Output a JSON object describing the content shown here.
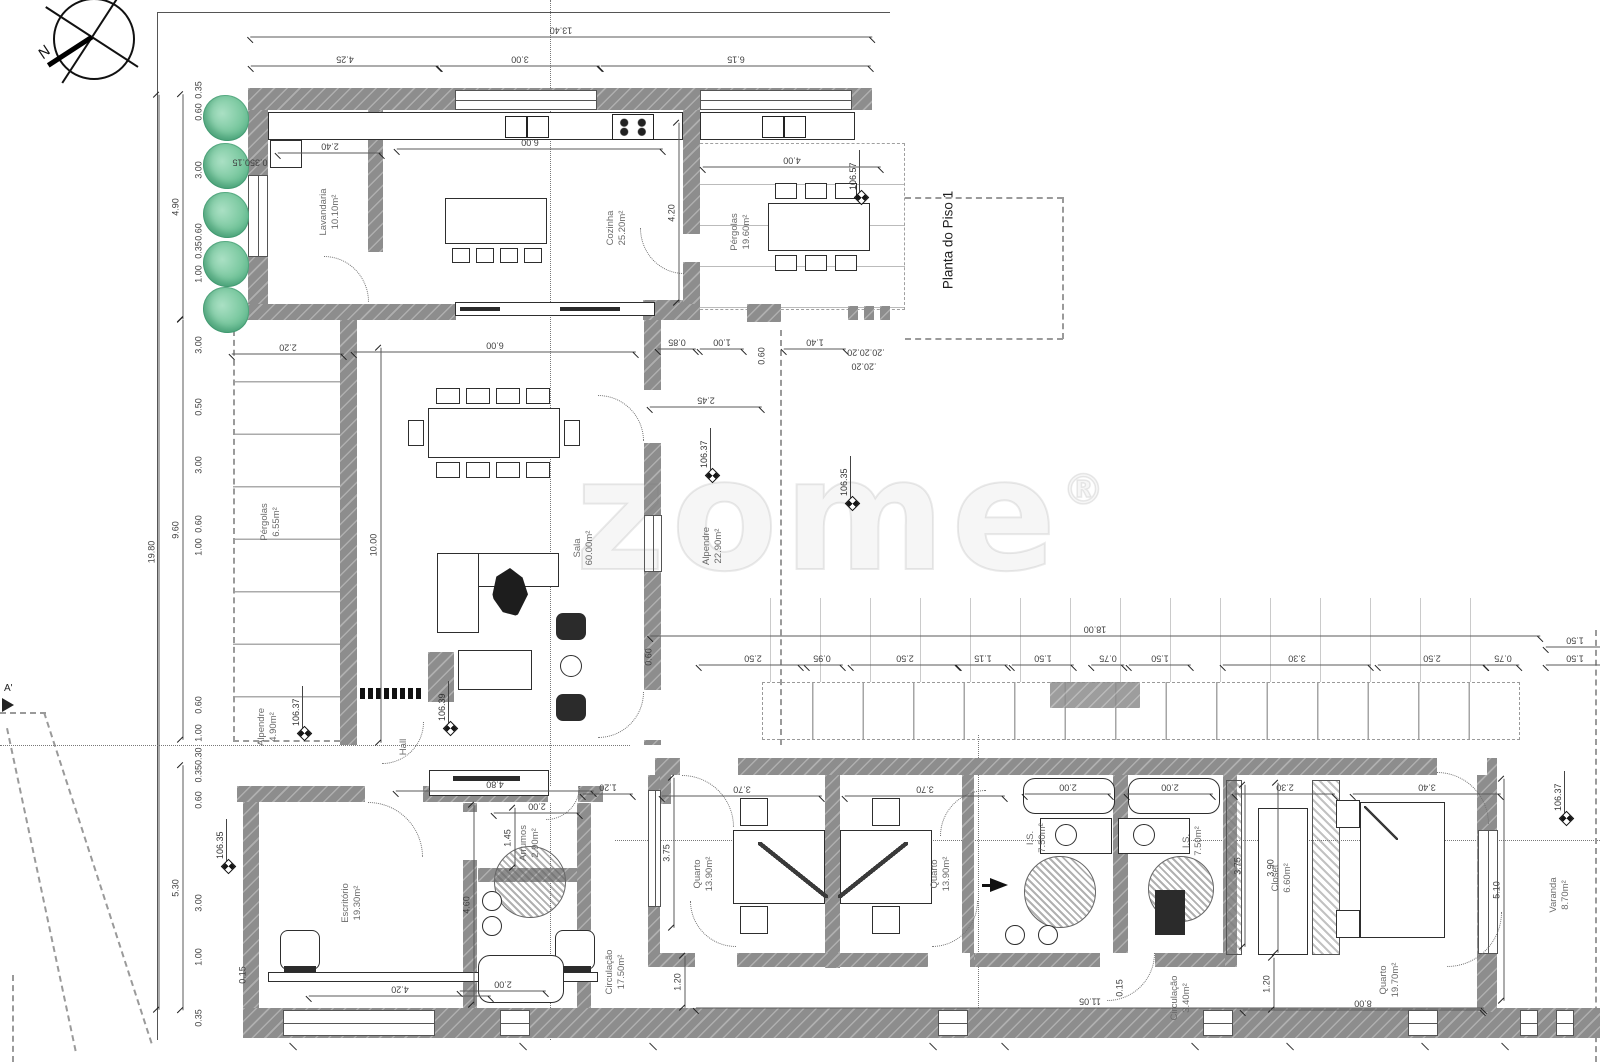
{
  "title": "Planta do Piso 1",
  "watermark": "zome",
  "watermark_reg": "®",
  "compass_label": "N",
  "section_label": "A'",
  "rooms": [
    {
      "n": "Lavandaria",
      "a": "10.10m²",
      "x": 330,
      "y": 212
    },
    {
      "n": "Cozinha",
      "a": "25.20m²",
      "x": 617,
      "y": 228
    },
    {
      "n": "Pérgolas",
      "a": "19.60m²",
      "x": 741,
      "y": 232
    },
    {
      "n": "Pérgolas",
      "a": "6.55m²",
      "x": 271,
      "y": 522
    },
    {
      "n": "Sala",
      "a": "60.00m²",
      "x": 584,
      "y": 548
    },
    {
      "n": "Alpendre",
      "a": "22.90m²",
      "x": 713,
      "y": 546
    },
    {
      "n": "Alpendre",
      "a": "4.90m²",
      "x": 268,
      "y": 727
    },
    {
      "n": "Hall",
      "a": "",
      "x": 404,
      "y": 747
    },
    {
      "n": "Escritório",
      "a": "19.30m²",
      "x": 352,
      "y": 903
    },
    {
      "n": "Arrumos",
      "a": "2.90m²",
      "x": 530,
      "y": 843
    },
    {
      "n": "Circulação",
      "a": "17.50m²",
      "x": 616,
      "y": 972
    },
    {
      "n": "Quarto",
      "a": "13.90m²",
      "x": 704,
      "y": 874
    },
    {
      "n": "Quarto",
      "a": "13.90m²",
      "x": 941,
      "y": 874
    },
    {
      "n": "I.S.",
      "a": "7.50m²",
      "x": 1037,
      "y": 838
    },
    {
      "n": "I.S.",
      "a": "7.50m²",
      "x": 1193,
      "y": 841
    },
    {
      "n": "Circulação",
      "a": "3.40m²",
      "x": 1181,
      "y": 998
    },
    {
      "n": "Closet",
      "a": "6.60m²",
      "x": 1282,
      "y": 878
    },
    {
      "n": "Quarto",
      "a": "19.70m²",
      "x": 1390,
      "y": 980
    },
    {
      "n": "Varanda",
      "a": "8.70m²",
      "x": 1560,
      "y": 895
    }
  ],
  "elevations": [
    {
      "v": "106.57",
      "x": 861,
      "y": 197
    },
    {
      "v": "106.37",
      "x": 712,
      "y": 475
    },
    {
      "v": "106.35",
      "x": 852,
      "y": 503
    },
    {
      "v": "106.37",
      "x": 304,
      "y": 733
    },
    {
      "v": "106.39",
      "x": 450,
      "y": 728
    },
    {
      "v": "106.35",
      "x": 228,
      "y": 866
    },
    {
      "v": "106.37",
      "x": 1566,
      "y": 818
    }
  ],
  "dims": [
    {
      "t": "13.40",
      "x": 561,
      "y": 30,
      "rot": 180,
      "len": 622
    },
    {
      "t": "4.25",
      "x": 345,
      "y": 59,
      "rot": 180,
      "len": 188
    },
    {
      "t": "3.00",
      "x": 520,
      "y": 59,
      "rot": 180,
      "len": 160
    },
    {
      "t": "6.15",
      "x": 736,
      "y": 59,
      "rot": 180,
      "len": 270
    },
    {
      "t": "2.40",
      "x": 330,
      "y": 146,
      "rot": 180,
      "len": 104
    },
    {
      "t": "6.00",
      "x": 530,
      "y": 142,
      "rot": 180,
      "len": 266
    },
    {
      "t": "4.00",
      "x": 792,
      "y": 160,
      "rot": 180,
      "len": 178
    },
    {
      "t": "0.350.15",
      "x": 250,
      "y": 162,
      "rot": 180
    },
    {
      "t": "19.80",
      "x": 152,
      "y": 552,
      "rot": -90,
      "len": 915
    },
    {
      "t": "4.90",
      "x": 176,
      "y": 207,
      "rot": -90,
      "len": 225
    },
    {
      "t": "9.60",
      "x": 176,
      "y": 530,
      "rot": -90,
      "len": 420
    },
    {
      "t": "5.30",
      "x": 176,
      "y": 888,
      "rot": -90,
      "len": 245
    },
    {
      "t": "0.35",
      "x": 199,
      "y": 90,
      "rot": -90
    },
    {
      "t": "0.60",
      "x": 199,
      "y": 112,
      "rot": -90
    },
    {
      "t": "3.00",
      "x": 199,
      "y": 170,
      "rot": -90
    },
    {
      "t": "0.60",
      "x": 199,
      "y": 232,
      "rot": -90
    },
    {
      "t": "0.35",
      "x": 199,
      "y": 250,
      "rot": -90
    },
    {
      "t": "1.00",
      "x": 199,
      "y": 274,
      "rot": -90
    },
    {
      "t": "3.00",
      "x": 199,
      "y": 345,
      "rot": -90
    },
    {
      "t": "0.50",
      "x": 199,
      "y": 407,
      "rot": -90
    },
    {
      "t": "3.00",
      "x": 199,
      "y": 465,
      "rot": -90
    },
    {
      "t": "0.60",
      "x": 199,
      "y": 524,
      "rot": -90
    },
    {
      "t": "1.00",
      "x": 199,
      "y": 547,
      "rot": -90
    },
    {
      "t": "0.60",
      "x": 199,
      "y": 705,
      "rot": -90
    },
    {
      "t": "1.00",
      "x": 199,
      "y": 733,
      "rot": -90
    },
    {
      "t": "0.350.30",
      "x": 199,
      "y": 765,
      "rot": -90
    },
    {
      "t": "0.60",
      "x": 199,
      "y": 800,
      "rot": -90
    },
    {
      "t": "3.00",
      "x": 199,
      "y": 903,
      "rot": -90
    },
    {
      "t": "1.00",
      "x": 199,
      "y": 957,
      "rot": -90
    },
    {
      "t": "0.35",
      "x": 199,
      "y": 1018,
      "rot": -90
    },
    {
      "t": "2.20",
      "x": 288,
      "y": 347,
      "rot": 180,
      "len": 112
    },
    {
      "t": "6.00",
      "x": 495,
      "y": 345,
      "rot": 180,
      "len": 282
    },
    {
      "t": "0.85",
      "x": 677,
      "y": 342,
      "rot": 180,
      "len": 38
    },
    {
      "t": "1.00",
      "x": 722,
      "y": 342,
      "rot": 180,
      "len": 44
    },
    {
      "t": "0.60",
      "x": 762,
      "y": 356,
      "rot": -90
    },
    {
      "t": "1.40",
      "x": 815,
      "y": 342,
      "rot": 180,
      "len": 62
    },
    {
      "t": ".20.20.20",
      "x": 866,
      "y": 352,
      "rot": 180
    },
    {
      "t": ".20.20",
      "x": 864,
      "y": 366,
      "rot": 180
    },
    {
      "t": "2.45",
      "x": 706,
      "y": 400,
      "rot": 180,
      "len": 112
    },
    {
      "t": "4.20",
      "x": 672,
      "y": 213,
      "rot": -90,
      "len": 180
    },
    {
      "t": "10.00",
      "x": 374,
      "y": 545,
      "rot": -90,
      "len": 395
    },
    {
      "t": "18.00",
      "x": 1095,
      "y": 629,
      "rot": 180,
      "len": 890
    },
    {
      "t": "1.50",
      "x": 1575,
      "y": 640,
      "rot": 180,
      "len": 58
    },
    {
      "t": "0.60",
      "x": 649,
      "y": 657,
      "rot": -90
    },
    {
      "t": "2.50",
      "x": 753,
      "y": 658,
      "rot": 180,
      "len": 108
    },
    {
      "t": "0.95",
      "x": 822,
      "y": 658,
      "rot": 180,
      "len": 42
    },
    {
      "t": "2.50",
      "x": 905,
      "y": 658,
      "rot": 180,
      "len": 108
    },
    {
      "t": "1.15",
      "x": 983,
      "y": 658,
      "rot": 180,
      "len": 50
    },
    {
      "t": "1.50",
      "x": 1043,
      "y": 658,
      "rot": 180,
      "len": 62
    },
    {
      "t": "0.75",
      "x": 1108,
      "y": 658,
      "rot": 180,
      "len": 33
    },
    {
      "t": "1.50",
      "x": 1160,
      "y": 658,
      "rot": 180,
      "len": 62
    },
    {
      "t": "3.30",
      "x": 1297,
      "y": 658,
      "rot": 180,
      "len": 148
    },
    {
      "t": "2.50",
      "x": 1432,
      "y": 658,
      "rot": 180,
      "len": 108
    },
    {
      "t": "0.75",
      "x": 1503,
      "y": 658,
      "rot": 180,
      "len": 33
    },
    {
      "t": "1.50",
      "x": 1575,
      "y": 658,
      "rot": 180,
      "len": 58
    },
    {
      "t": "4.80",
      "x": 495,
      "y": 784,
      "rot": 180,
      "len": 198
    },
    {
      "t": "2.00",
      "x": 537,
      "y": 806,
      "rot": 180,
      "len": 86
    },
    {
      "t": "1.45",
      "x": 508,
      "y": 838,
      "rot": -90,
      "len": 60
    },
    {
      "t": "4.60",
      "x": 467,
      "y": 905,
      "rot": -90,
      "len": 200
    },
    {
      "t": "1.20",
      "x": 608,
      "y": 787,
      "rot": 180,
      "len": 50
    },
    {
      "t": "3.70",
      "x": 742,
      "y": 789,
      "rot": 180,
      "len": 160
    },
    {
      "t": "3.70",
      "x": 925,
      "y": 789,
      "rot": 180,
      "len": 160
    },
    {
      "t": "2.00",
      "x": 1068,
      "y": 787,
      "rot": 180,
      "len": 86
    },
    {
      "t": "2.00",
      "x": 1170,
      "y": 787,
      "rot": 180,
      "len": 86
    },
    {
      "t": "2.30",
      "x": 1285,
      "y": 787,
      "rot": 180,
      "len": 100
    },
    {
      "t": "3.40",
      "x": 1427,
      "y": 787,
      "rot": 180,
      "len": 148
    },
    {
      "t": "3.75",
      "x": 667,
      "y": 853,
      "rot": -90,
      "len": 150
    },
    {
      "t": "0.15",
      "x": 243,
      "y": 975,
      "rot": -90
    },
    {
      "t": "4.20",
      "x": 400,
      "y": 989,
      "rot": 180,
      "len": 182
    },
    {
      "t": "2.00",
      "x": 503,
      "y": 984,
      "rot": 180,
      "len": 86
    },
    {
      "t": "1.20",
      "x": 678,
      "y": 982,
      "rot": -90,
      "len": 52
    },
    {
      "t": "11.05",
      "x": 1090,
      "y": 1001,
      "rot": 180,
      "len": 788
    },
    {
      "t": "0.15",
      "x": 1120,
      "y": 988,
      "rot": -90
    },
    {
      "t": "3.75",
      "x": 1238,
      "y": 866,
      "rot": -90,
      "len": 162
    },
    {
      "t": "3.90",
      "x": 1271,
      "y": 868,
      "rot": -90,
      "len": 170
    },
    {
      "t": "5.10",
      "x": 1497,
      "y": 890,
      "rot": -90,
      "len": 222
    },
    {
      "t": "1.20",
      "x": 1267,
      "y": 984,
      "rot": -90,
      "len": 52
    },
    {
      "t": "8.00",
      "x": 1363,
      "y": 1003,
      "rot": 180,
      "len": 240
    }
  ],
  "trees": [
    {
      "x": 226,
      "y": 118
    },
    {
      "x": 226,
      "y": 166
    },
    {
      "x": 226,
      "y": 215
    },
    {
      "x": 226,
      "y": 264
    },
    {
      "x": 226,
      "y": 310
    }
  ]
}
